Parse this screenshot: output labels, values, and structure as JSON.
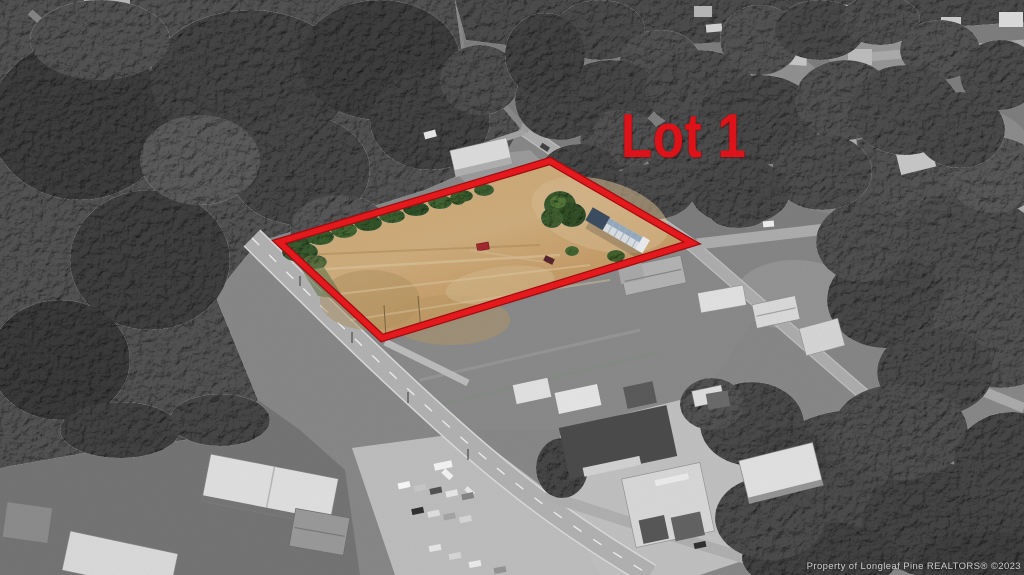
{
  "scene": {
    "description": "Black-and-white aerial photograph of a rural highway corridor; one land parcel is shown in color and outlined",
    "colors": {
      "boundary_red": "#e8171d",
      "label_red": "#dd1319",
      "parcel_tan": "#cda56c",
      "parcel_tree_green": "#3c5c2e",
      "forest_gray": "#4a4a4a",
      "field_gray": "#8c8c8c",
      "road_gray": "#b7b7b7",
      "mobile_home_roof_blue": "#8ea6bd",
      "red_car": "#a82a31"
    }
  },
  "annotation": {
    "lot_label": "Lot 1",
    "boundary_points": "279,242 550,161 692,243 382,338"
  },
  "watermark": {
    "text": "Property of Longleaf Pine REALTORS® ©2023"
  }
}
